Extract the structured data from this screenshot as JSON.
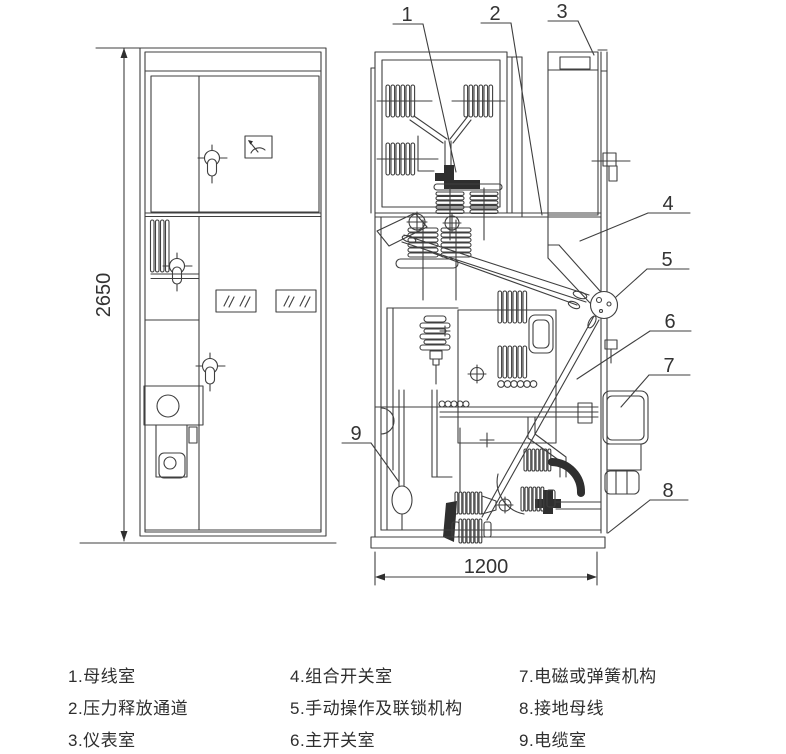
{
  "colors": {
    "background": "#ffffff",
    "line": "#3f3f3f",
    "text": "#333333"
  },
  "drawing": {
    "description": "switchgear cabinet structure diagram, front view and side section view",
    "dimensions": {
      "height": "2650",
      "width": "1200"
    },
    "callouts": [
      "1",
      "2",
      "3",
      "4",
      "5",
      "6",
      "7",
      "8",
      "9"
    ]
  },
  "legend": {
    "items": [
      {
        "num": "1",
        "label": "母线室",
        "text": "1.母线室"
      },
      {
        "num": "2",
        "label": "压力释放通道",
        "text": "2.压力释放通道"
      },
      {
        "num": "3",
        "label": "仪表室",
        "text": "3.仪表室"
      },
      {
        "num": "4",
        "label": "组合开关室",
        "text": "4.组合开关室"
      },
      {
        "num": "5",
        "label": "手动操作及联锁机构",
        "text": "5.手动操作及联锁机构"
      },
      {
        "num": "6",
        "label": "主开关室",
        "text": "6.主开关室"
      },
      {
        "num": "7",
        "label": "电磁或弹簧机构",
        "text": "7.电磁或弹簧机构"
      },
      {
        "num": "8",
        "label": "接地母线",
        "text": "8.接地母线"
      },
      {
        "num": "9",
        "label": "电缆室",
        "text": "9.电缆室"
      }
    ]
  }
}
